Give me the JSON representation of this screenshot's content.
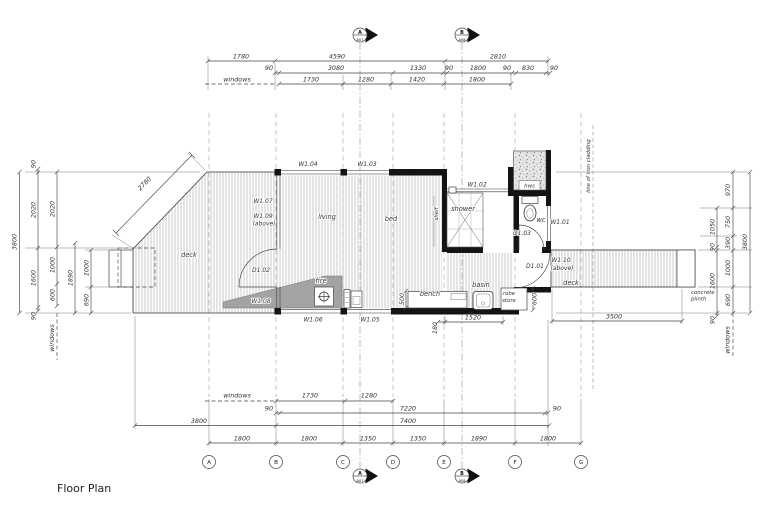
{
  "title": "Floor Plan",
  "top_dims": {
    "windows_label": "windows",
    "row1": [
      "1780",
      "4590",
      "2810"
    ],
    "row2": [
      "90",
      "3080",
      "1330",
      "90",
      "1800",
      "90",
      "830",
      "90"
    ],
    "row3": [
      "1730",
      "1280",
      "1420",
      "1800"
    ]
  },
  "bottom_dims": {
    "windows_label": "windows",
    "row1": [
      "1730",
      "1280"
    ],
    "row2": [
      "90",
      "7220",
      "90"
    ],
    "row3": [
      "3800",
      "7400"
    ],
    "row4": [
      "1800",
      "1800",
      "1350",
      "1350",
      "1890",
      "1800"
    ],
    "deck_dim": "3500",
    "grid_labels": [
      "A",
      "B",
      "C",
      "D",
      "E",
      "F",
      "G"
    ]
  },
  "left_dims": {
    "overall": "3800",
    "col2": [
      "90",
      "2020",
      "1600",
      "90"
    ],
    "col3": [
      "2020",
      "1000",
      "600"
    ],
    "col4": "1890",
    "col5": [
      "1000",
      "690"
    ],
    "windows_label": "windows"
  },
  "right_dims": {
    "overall": "3800",
    "inner": [
      "1050",
      "90",
      "1600",
      "90"
    ],
    "outer": [
      "970",
      "750",
      "390",
      "1000",
      "690"
    ],
    "windows_label": "windows"
  },
  "markers": {
    "a_letter": "A",
    "a_sheet": "A07",
    "b_letter": "B",
    "b_sheet": "A08"
  },
  "rooms": {
    "deck_left": "deck",
    "living": "living",
    "bed": "bed",
    "shelf": "shelf",
    "shower": "shower",
    "wc": "wc",
    "hws": "hws",
    "fire": "fire",
    "bench": "bench",
    "basin": "basin",
    "robe_line1": "robe",
    "robe_line2": "store",
    "deck_right": "deck"
  },
  "openings": {
    "w101": "W1.01",
    "w102": "W1.02",
    "w103": "W1.03",
    "w104": "W1.04",
    "w105": "W1.05",
    "w106": "W1.06",
    "w107": "W1.07",
    "w108": "W1.08",
    "w109a": "W1.09",
    "w109b": "(above)",
    "w110a": "W1.10",
    "w110b": "(above)",
    "d101": "D1.01",
    "d102": "D1.02",
    "d103": "D1.03"
  },
  "inline_dims": {
    "deck_diag": "2780",
    "bench_depth": "500",
    "robe_depth": "600",
    "wall_run": "1520",
    "offset": "180"
  },
  "notes": {
    "cladding": "line of iron cladding",
    "plinth1": "concrete",
    "plinth2": "plinth"
  }
}
